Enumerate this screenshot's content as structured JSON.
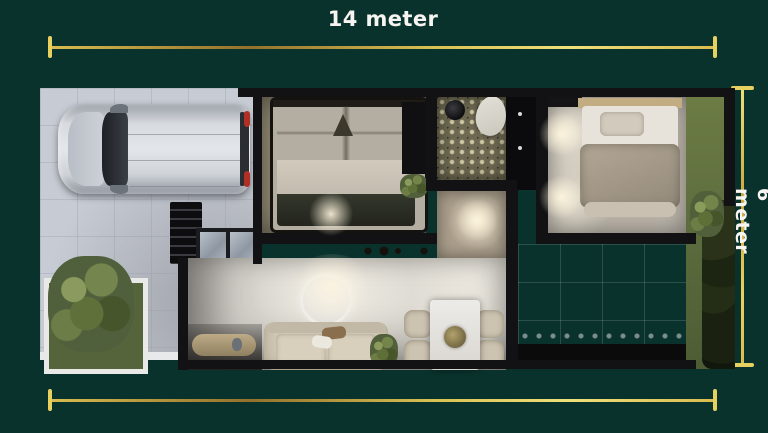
{
  "dimensions": {
    "top_label": "14 meter",
    "right_label": "6 meter"
  },
  "palette": {
    "background": "#0a322c",
    "dimension_gold": "#e6d160",
    "label_text": "#f6f5f2",
    "wall_black": "#121214",
    "driveway_tile": "#c7cbd3",
    "living_floor": "#d6d3cd",
    "bedroom1_floor": "#a1977f",
    "bedroom2_floor": "#beb8ad",
    "bathroom_tile": "#6e6952",
    "patio_tile": "#9599a4",
    "grass_green": "#5f6e3c",
    "car_silver": "#d7dade"
  }
}
